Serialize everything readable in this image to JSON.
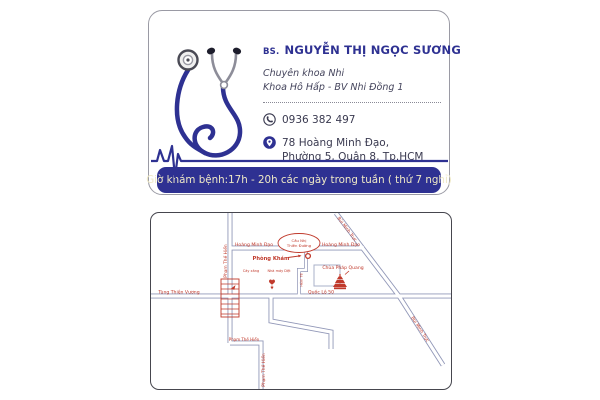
{
  "business_card": {
    "title_prefix": "BS.",
    "doctor_name": "NGUYỄN THỊ NGỌC SƯƠNG",
    "specialty": "Chuyên khoa Nhi",
    "department": "Khoa Hô Hấp - BV Nhi Đồng 1",
    "phone": "0936 382 497",
    "address_line1": "78 Hoàng Minh Đạo,",
    "address_line2": "Phường 5, Quận 8, Tp.HCM",
    "hours_banner": "Giờ khám bệnh:17h - 20h các ngày trong tuần ( thứ 7 nghỉ)",
    "accent_color": "#2e3192"
  },
  "map_card": {
    "roundabout_line1": "Cầu Nhị",
    "roundabout_line2": "Thiên Đường",
    "road_hoang_minh_dao_left": "Hoàng Minh Đạo",
    "road_hoang_minh_dao_right": "Hoàng Minh Đạo",
    "road_bui_minh_truc_top": "Bùi Minh Trực",
    "road_bui_minh_truc_bottom": "Bùi Minh Trực",
    "road_pham_the_hien_left": "Phạm Thế Hiển",
    "road_pham_the_hien_mid": "Phạm Thế Hiển",
    "road_pham_the_hien_bottom": "Phạm Thế Hiển",
    "road_tung_thien_vuong": "Tùng Thiện Vương",
    "road_quoc_lo_50": "Quốc Lộ 50",
    "label_clinic": "Phòng Khám",
    "label_pagoda": "Chùa Pháp Quang",
    "label_small_left": "Cây xăng",
    "label_small_right": "Nhà máy Dệt",
    "label_alley": "Hẻm 78",
    "road_color": "#9298b8",
    "label_color": "#c0392b"
  }
}
